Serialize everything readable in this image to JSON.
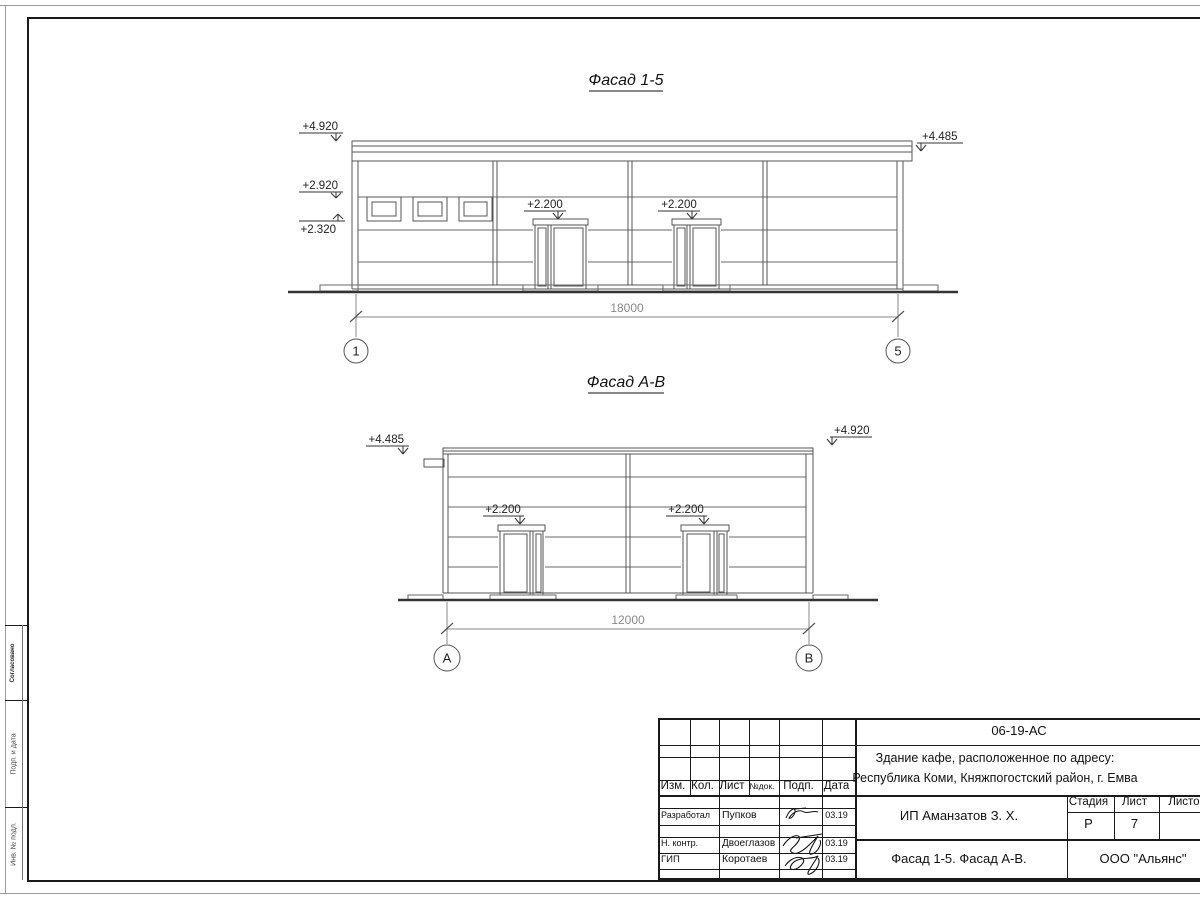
{
  "drawings": {
    "f15": {
      "title": "Фасад 1-5",
      "mark_4920": "+4.920",
      "mark_2920": "+2.920",
      "mark_2320": "+2.320",
      "mark_4485": "+4.485",
      "door_mark": "+2.200",
      "dimension": "18000",
      "axis_left": "1",
      "axis_right": "5"
    },
    "fab": {
      "title": "Фасад А-В",
      "mark_4485": "+4.485",
      "mark_4920": "+4.920",
      "door_mark": "+2.200",
      "dimension": "12000",
      "axis_left": "А",
      "axis_right": "В"
    }
  },
  "title_block": {
    "doc_code": "06-19-АС",
    "object_line1": "Здание кафе, расположенное по адресу:",
    "object_line2": "Республика Коми, Княжпогостский район, г. Емва",
    "columns": {
      "izm": "Изм.",
      "kol": "Кол.",
      "list": "Лист",
      "doc_no": "№док.",
      "sign": "Подп.",
      "date": "Дата"
    },
    "rows": [
      {
        "role": "Разработал",
        "name": "Пупков",
        "date": "03.19"
      },
      {
        "role": "Н. контр.",
        "name": "Двоеглазов",
        "date": "03.19"
      },
      {
        "role": "ГИП",
        "name": "Коротаев",
        "date": "03.19"
      }
    ],
    "client": "ИП Аманзатов З. Х.",
    "stage_label": "Стадия",
    "sheet_label": "Лист",
    "sheets_label": "Листов",
    "stage_value": "Р",
    "sheet_value": "7",
    "content_title": "Фасад 1-5. Фасад А-В.",
    "organization": "ООО \"Альянс\""
  },
  "margin_stamps": {
    "top": "Согласовано",
    "middle": "Подп. и дата",
    "bottom": "Инв. № подл."
  }
}
